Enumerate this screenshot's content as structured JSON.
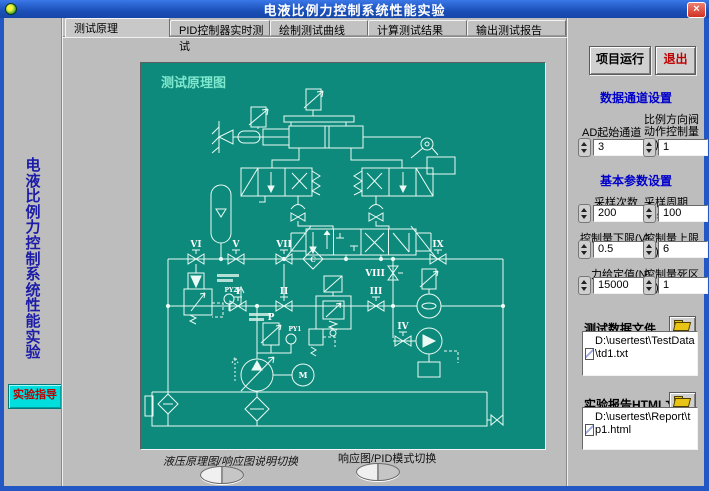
{
  "window": {
    "title": "电液比例力控制系统性能实验",
    "close_glyph": "×"
  },
  "tabs": [
    {
      "label": "测试原理",
      "active": true
    },
    {
      "label": "PID控制器实时测试",
      "active": false
    },
    {
      "label": "绘制测试曲线",
      "active": false
    },
    {
      "label": "计算测试结果",
      "active": false
    },
    {
      "label": "输出测试报告",
      "active": false
    }
  ],
  "sidebar": {
    "title": "电液比例力控制系统性能实验",
    "guide_button": "实验指导"
  },
  "diagram": {
    "labels": {
      "title": "测试原理图",
      "I": "I",
      "II": "II",
      "III": "III",
      "IV": "IV",
      "V": "V",
      "VI": "VI",
      "VII": "VII",
      "VIII": "VIII",
      "IX": "IX",
      "P": "P",
      "PY1": "PY1",
      "PY2": "PY2",
      "M": "M",
      "C": "C"
    }
  },
  "switches": [
    {
      "label": "液压原理图/响应图说明切换"
    },
    {
      "label": "响应图/PID模式切换"
    }
  ],
  "right_panel": {
    "run_button": "项目运行",
    "exit_button": "退出",
    "section_channels": "数据通道设置",
    "channel_controls": [
      {
        "label": "AD起始通道",
        "label2": "",
        "value": "3"
      },
      {
        "label": "比例方向阀",
        "label2": "动作控制量(V)",
        "value": "1"
      }
    ],
    "section_params": "基本参数设置",
    "params": [
      {
        "label": "采样次数",
        "value": "200"
      },
      {
        "label": "采样周期(ms)",
        "value": "100"
      },
      {
        "label": "控制量下限(V)",
        "value": "0.5"
      },
      {
        "label": "控制量上限(V)",
        "value": "6"
      },
      {
        "label": "力给定值(N)",
        "value": "15000"
      },
      {
        "label": "控制量死区(V)",
        "value": "1"
      }
    ],
    "data_file": {
      "label": "测试数据文件",
      "value": "D:\\usertest\\TestData\\td1.txt"
    },
    "report_file": {
      "label": "实验报告HTML文件",
      "value": "D:\\usertest\\Report\\tp1.html"
    }
  }
}
